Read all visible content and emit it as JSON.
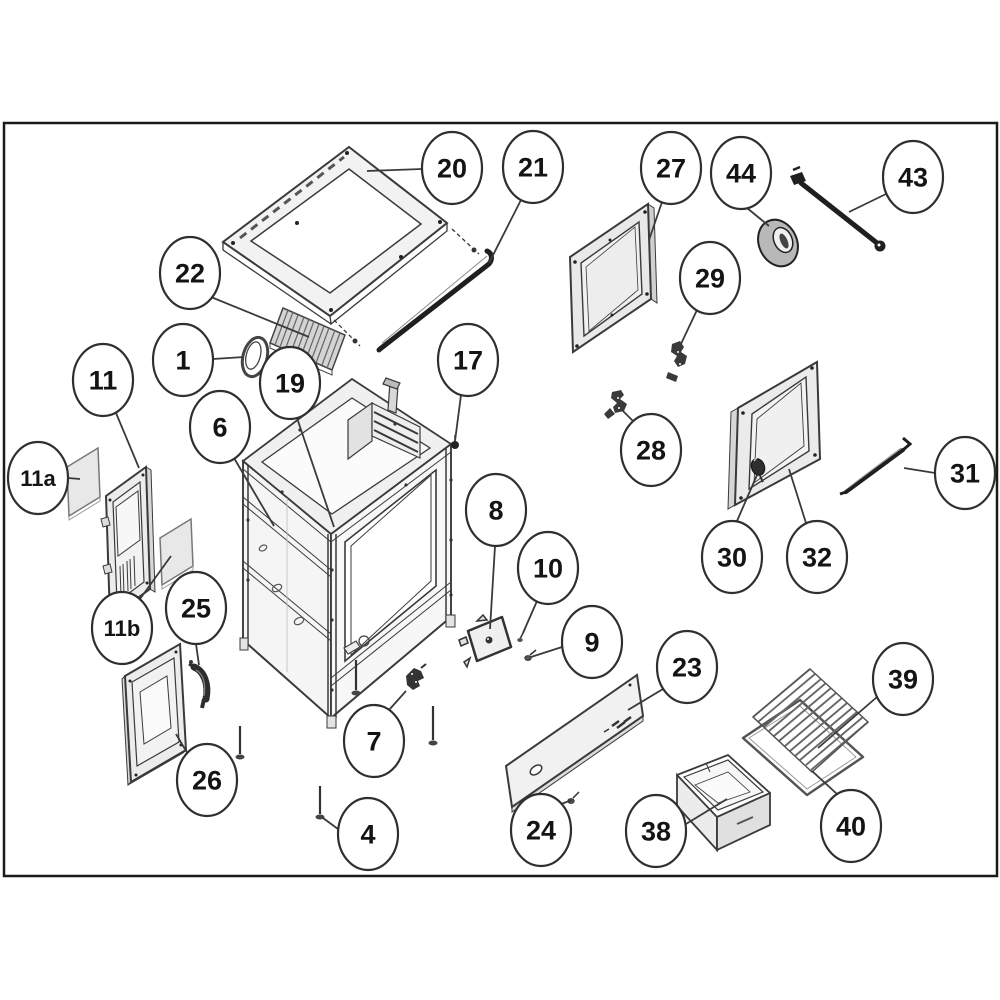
{
  "figure": {
    "type": "exploded-parts-diagram",
    "subject": "freestanding stove / range exploded view with numbered part callouts",
    "background": "#ffffff",
    "border_color": "#1a1a1a",
    "line_color": "#3a3a3a",
    "panel_fill": "#ececec",
    "dark_part_color": "#1f1f1f",
    "border_box": {
      "x": 4,
      "y": 123,
      "width": 993,
      "height": 753
    }
  },
  "balloon": {
    "rx": 30,
    "ry": 36,
    "stroke": "#2f2f2f",
    "fill": "#ffffff"
  },
  "callouts": [
    {
      "label": "20",
      "x": 452,
      "y": 168,
      "leader": [
        422,
        169,
        367,
        171
      ]
    },
    {
      "label": "21",
      "x": 533,
      "y": 167,
      "leader": [
        523,
        196,
        489,
        263
      ]
    },
    {
      "label": "22",
      "x": 190,
      "y": 273,
      "leader": [
        211,
        297,
        309,
        337
      ]
    },
    {
      "label": "1",
      "x": 183,
      "y": 360,
      "leader": [
        213,
        359,
        244,
        357
      ]
    },
    {
      "label": "19",
      "x": 290,
      "y": 383,
      "leader": [
        297,
        418,
        334,
        527
      ]
    },
    {
      "label": "6",
      "x": 220,
      "y": 427,
      "leader": [
        234,
        458,
        274,
        526
      ]
    },
    {
      "label": "17",
      "x": 468,
      "y": 360,
      "leader": [
        461,
        395,
        455,
        441
      ]
    },
    {
      "label": "27",
      "x": 671,
      "y": 168,
      "leader": [
        662,
        202,
        649,
        240
      ]
    },
    {
      "label": "44",
      "x": 741,
      "y": 173,
      "leader": [
        747,
        208,
        769,
        226
      ]
    },
    {
      "label": "43",
      "x": 913,
      "y": 177,
      "leader": [
        886,
        194,
        849,
        212
      ]
    },
    {
      "label": "29",
      "x": 710,
      "y": 278,
      "leader": [
        697,
        310,
        680,
        346
      ]
    },
    {
      "label": "28",
      "x": 651,
      "y": 450,
      "leader": [
        633,
        421,
        621,
        409
      ]
    },
    {
      "label": "11",
      "x": 103,
      "y": 380,
      "leader": [
        116,
        413,
        139,
        468
      ]
    },
    {
      "label": "11a",
      "x": 38,
      "y": 478,
      "leader": [
        68,
        478,
        80,
        479
      ]
    },
    {
      "label": "11b",
      "x": 122,
      "y": 628,
      "leader": [
        140,
        599,
        171,
        556
      ]
    },
    {
      "label": "25",
      "x": 196,
      "y": 608,
      "leader": [
        196,
        644,
        199,
        665
      ]
    },
    {
      "label": "26",
      "x": 207,
      "y": 780,
      "leader": [
        195,
        766,
        176,
        734
      ]
    },
    {
      "label": "30",
      "x": 732,
      "y": 557,
      "leader": [
        737,
        521,
        757,
        475
      ]
    },
    {
      "label": "32",
      "x": 817,
      "y": 557,
      "leader": [
        806,
        523,
        789,
        469
      ]
    },
    {
      "label": "31",
      "x": 965,
      "y": 473,
      "leader": [
        935,
        473,
        904,
        468
      ]
    },
    {
      "label": "8",
      "x": 496,
      "y": 510,
      "leader": [
        495,
        546,
        490,
        629
      ]
    },
    {
      "label": "10",
      "x": 548,
      "y": 568,
      "leader": [
        537,
        601,
        523,
        633
      ]
    },
    {
      "label": "9",
      "x": 592,
      "y": 642,
      "leader": [
        562,
        647,
        531,
        657
      ]
    },
    {
      "label": "23",
      "x": 687,
      "y": 667,
      "leader": [
        663,
        689,
        628,
        710
      ]
    },
    {
      "label": "24",
      "x": 541,
      "y": 830,
      "leader": [
        553,
        807,
        572,
        800
      ]
    },
    {
      "label": "7",
      "x": 374,
      "y": 741,
      "leader": [
        389,
        710,
        406,
        691
      ]
    },
    {
      "label": "4",
      "x": 368,
      "y": 834,
      "leader": [
        338,
        829,
        323,
        818
      ]
    },
    {
      "label": "38",
      "x": 656,
      "y": 831,
      "leader": [
        686,
        824,
        727,
        799
      ]
    },
    {
      "label": "39",
      "x": 903,
      "y": 679,
      "leader": [
        877,
        697,
        818,
        748
      ]
    },
    {
      "label": "40",
      "x": 851,
      "y": 826,
      "leader": [
        837,
        794,
        812,
        771
      ]
    }
  ]
}
